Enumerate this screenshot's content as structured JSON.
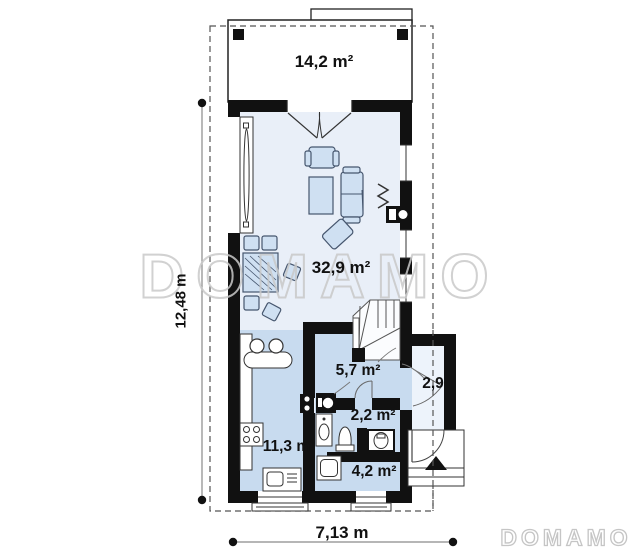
{
  "plan": {
    "title_context": "floor-plan",
    "rooms": {
      "terrace": {
        "label": "14,2 m²"
      },
      "living_room": {
        "label": "32,9 m²"
      },
      "hall": {
        "label": "5,7 m²"
      },
      "vestibule": {
        "label": "2,9"
      },
      "bathroom": {
        "label": "2,2 m²"
      },
      "kitchen": {
        "label": "11,3 m²"
      },
      "entry": {
        "label": "4,2 m²"
      }
    },
    "dimensions": {
      "left_vertical": "12,48 m",
      "bottom_horizontal": "7,13 m"
    },
    "watermark": {
      "center": "DOMAMO",
      "corner": "DOMAMO"
    },
    "colors": {
      "wall": "#111111",
      "room_fill_light": "#e9eff8",
      "zone_fill": "#c8dbef",
      "annex_fill": "#edf3fb",
      "furniture_fill": "#cfe0f2",
      "furniture_stroke": "#46566e",
      "watermark_outline": "#c9c9c9",
      "dimension_line": "#8a8a8a"
    },
    "icons": [
      "stairs-icon",
      "fireplace-icon",
      "radiator-icon",
      "sink-icon",
      "stove-icon",
      "oven-icon",
      "toilet-icon",
      "washbasin-icon",
      "washing-machine-icon",
      "entrance-arrow-icon",
      "door-swing-icon",
      "window-icon",
      "column-icon",
      "sofa-icon",
      "armchair-icon",
      "dining-table-icon",
      "chair-icon",
      "coffee-table-icon"
    ]
  }
}
